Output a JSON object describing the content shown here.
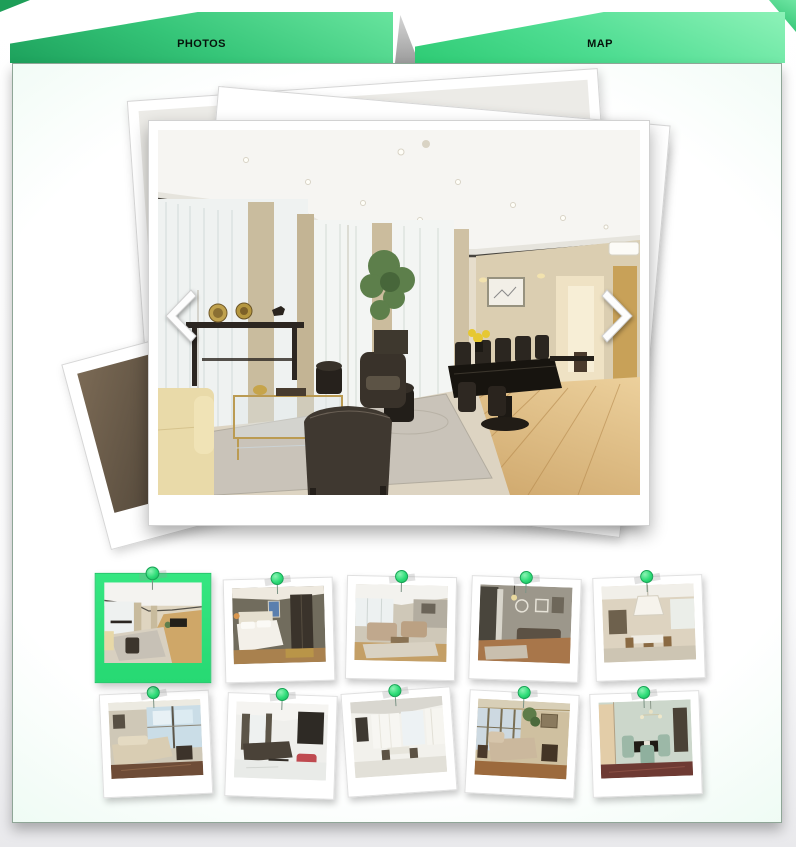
{
  "tabs": [
    {
      "label": "PHOTOS",
      "active": true
    },
    {
      "label": "MAP",
      "active": false
    }
  ],
  "carousel": {
    "main_photo_alt": "Living and dining room with floor-to-ceiling windows",
    "stacked_photo_count": 3,
    "prev_control": "previous-photo",
    "next_control": "next-photo"
  },
  "gallery": {
    "selected_index": 0,
    "rows": 2,
    "columns": 5,
    "thumbnails": [
      {
        "alt": "Living room with wood floor"
      },
      {
        "alt": "Bedroom with white bed"
      },
      {
        "alt": "Living room with beige sofas"
      },
      {
        "alt": "Lounge with wall decor"
      },
      {
        "alt": "Room with large lamp"
      },
      {
        "alt": "Lounge with corner windows"
      },
      {
        "alt": "Living room with white floor"
      },
      {
        "alt": "Bright sitting room"
      },
      {
        "alt": "Chaise lounge by window"
      },
      {
        "alt": "Dining room with chandelier"
      }
    ]
  },
  "colors": {
    "tab_photos_gradient_start": "#68e49e",
    "tab_photos_gradient_end": "#1da15c",
    "tab_map_gradient_start": "#8df2b8",
    "tab_map_gradient_end": "#2ecb74",
    "accent_green": "#2edd78",
    "selected_frame": "#2ee47c",
    "panel_edge": "#cdf0dd"
  }
}
